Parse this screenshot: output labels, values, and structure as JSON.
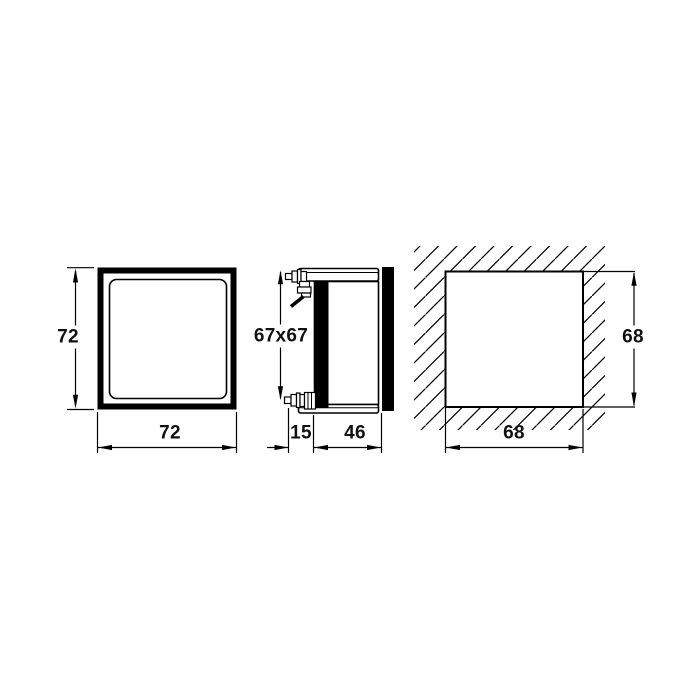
{
  "page": {
    "background_color": "#ffffff",
    "line_color": "#000000"
  },
  "views": {
    "front": {
      "height_label": "72",
      "width_label": "72"
    },
    "side": {
      "face_label": "67x67",
      "front_depth_label": "15",
      "body_depth_label": "46"
    },
    "panel_cutout": {
      "width_label": "68",
      "height_label": "68"
    }
  }
}
